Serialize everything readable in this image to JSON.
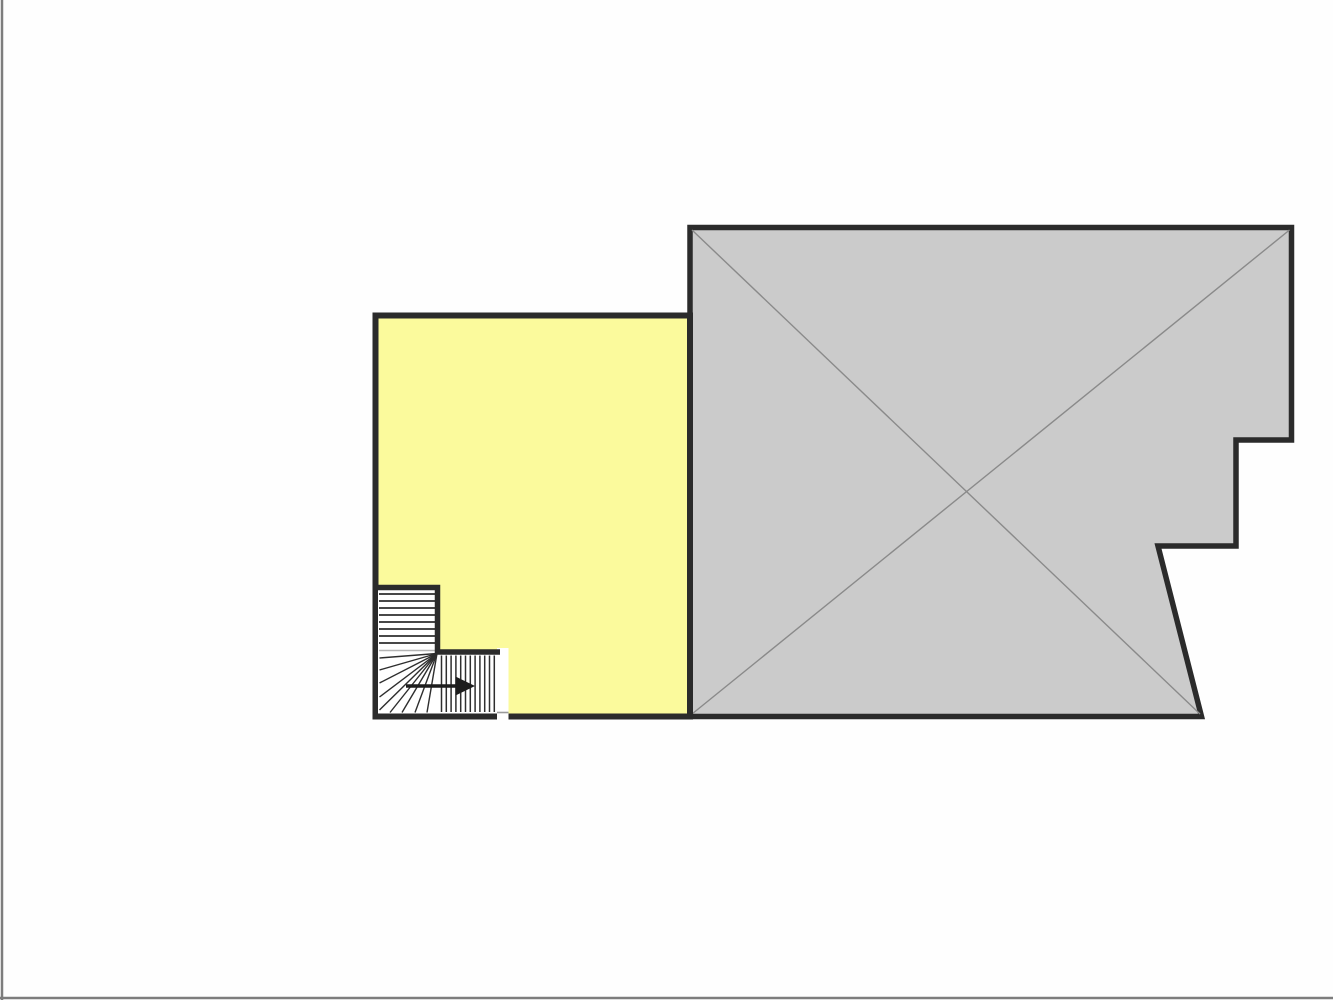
{
  "window": {
    "background": "#fefefe",
    "edge_border_color": "#7d7d7d"
  },
  "palette": {
    "room_fill": "#fbfa9c",
    "void_fill": "#cbcbcb",
    "wall": "#2b2b2b",
    "diagonal_line": "#8a8a8a",
    "tread_line": "#2e2e2e",
    "winder_separator": "#b4b4b4",
    "stair_fill": "#ffffff",
    "opening_line": "#9a9a9a",
    "arrow": "#1d1d1d"
  },
  "floor_plan": {
    "room": {
      "shape": "rectangular",
      "marking": "none"
    },
    "void_area": {
      "marking": "diagonal-cross"
    },
    "staircase": {
      "upper_flight_treads": 8,
      "winder_treads": 9,
      "lower_flight_treads": 12,
      "direction_arrow": "right"
    }
  }
}
